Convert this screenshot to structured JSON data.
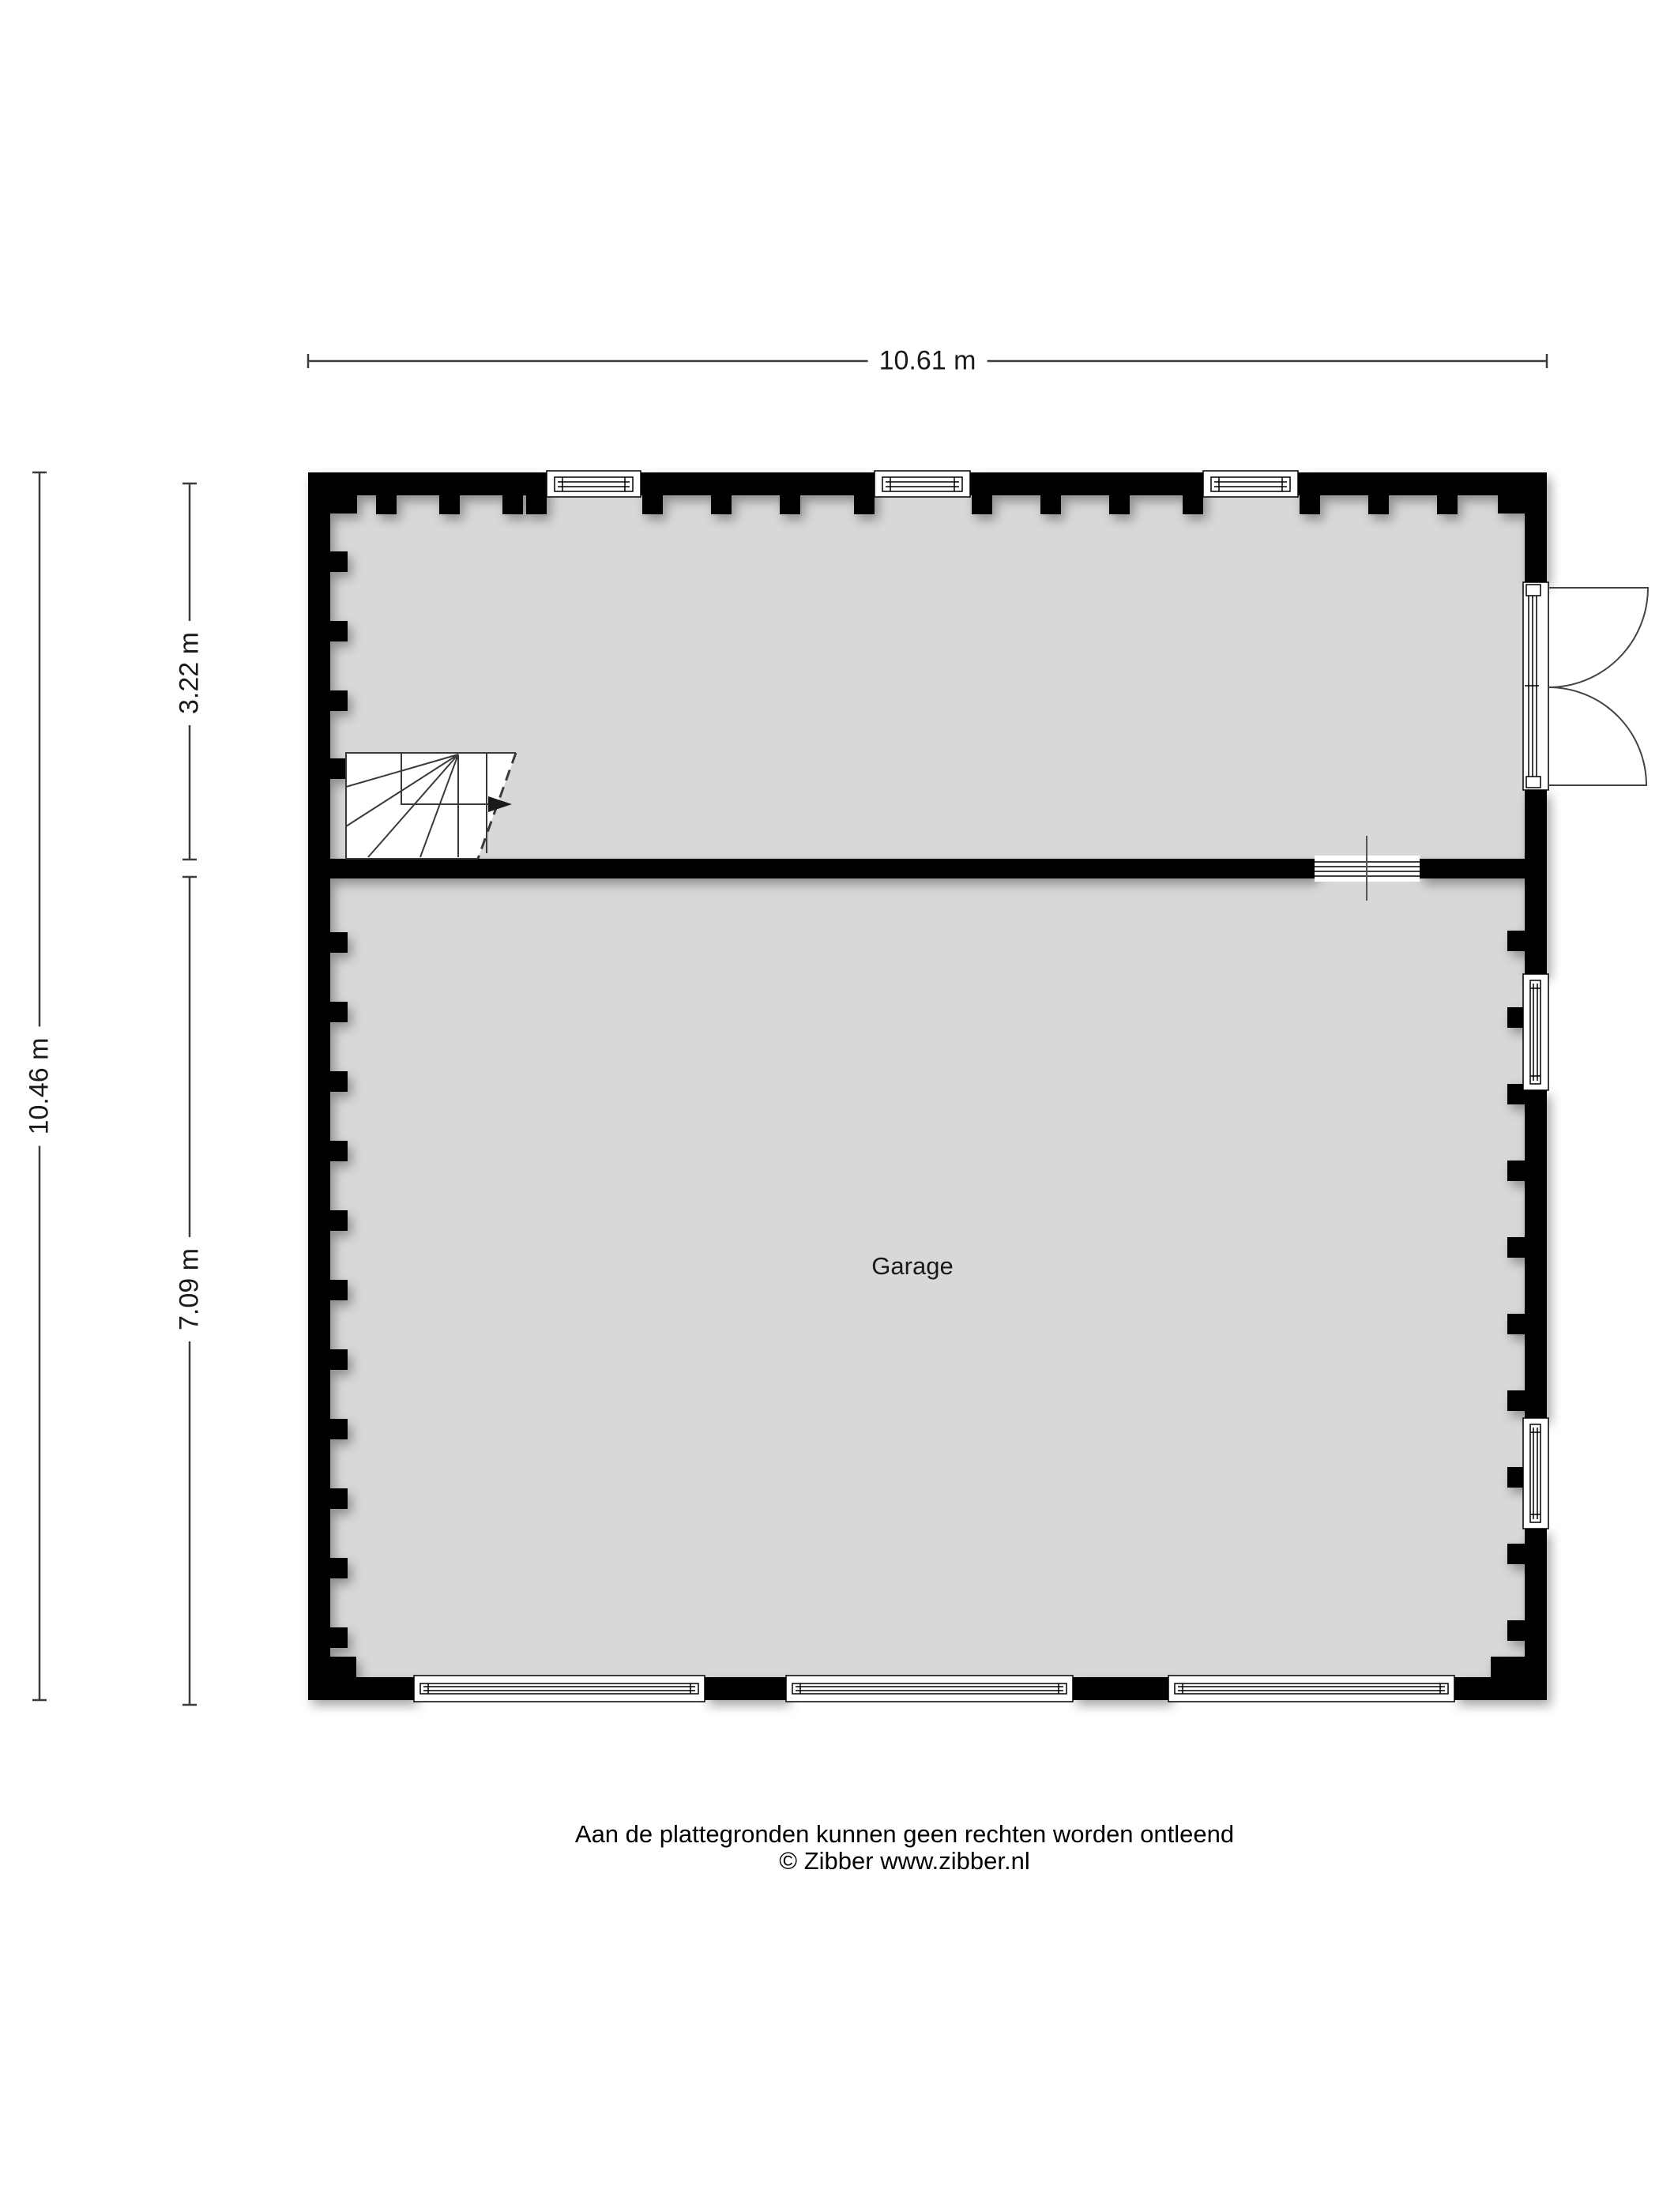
{
  "dimensions": {
    "total_width": "10.61 m",
    "total_height": "10.46 m",
    "top_room_height": "3.22 m",
    "garage_height": "7.09 m"
  },
  "rooms": {
    "garage_label": "Garage"
  },
  "footer": {
    "disclaimer": "Aan de plattegronden kunnen geen rechten worden ontleend",
    "copyright": "© Zibber www.zibber.nl"
  },
  "colors": {
    "wall": "#000000",
    "floor": "#d8d8d8",
    "dimension_line": "#3c3c3c",
    "background": "#ffffff"
  }
}
